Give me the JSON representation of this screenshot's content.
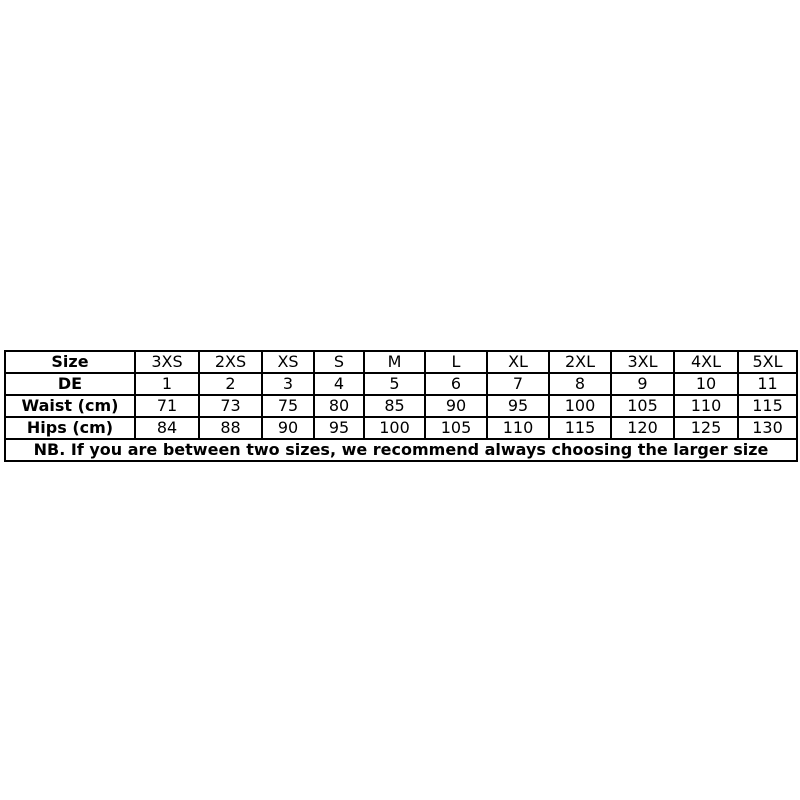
{
  "size_chart": {
    "rows": [
      {
        "label": "Size",
        "values": [
          "3XS",
          "2XS",
          "XS",
          "S",
          "M",
          "L",
          "XL",
          "2XL",
          "3XL",
          "4XL",
          "5XL"
        ]
      },
      {
        "label": "DE",
        "values": [
          "1",
          "2",
          "3",
          "4",
          "5",
          "6",
          "7",
          "8",
          "9",
          "10",
          "11"
        ]
      },
      {
        "label": "Waist (cm)",
        "values": [
          "71",
          "73",
          "75",
          "80",
          "85",
          "90",
          "95",
          "100",
          "105",
          "110",
          "115"
        ]
      },
      {
        "label": "Hips (cm)",
        "values": [
          "84",
          "88",
          "90",
          "95",
          "100",
          "105",
          "110",
          "115",
          "120",
          "125",
          "130"
        ]
      }
    ],
    "note": "NB. If you are between two sizes, we recommend always choosing the larger size",
    "colors": {
      "border": "#000000",
      "text": "#000000",
      "background": "#ffffff"
    }
  }
}
